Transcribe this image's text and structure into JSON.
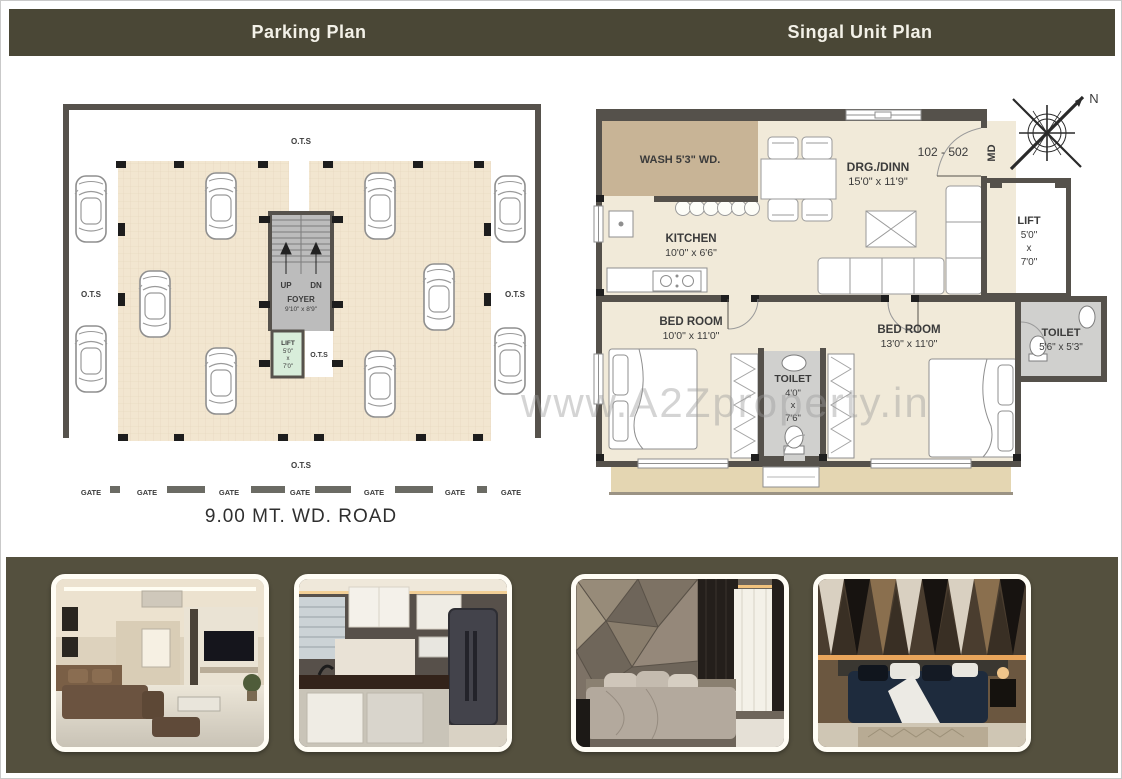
{
  "header": {
    "left_title": "Parking Plan",
    "right_title": "Singal Unit Plan"
  },
  "parking_plan": {
    "ots_top": "O.T.S",
    "ots_left": "O.T.S",
    "ots_right": "O.T.S",
    "ots_bottom": "O.T.S",
    "ots_inner": "O.T.S",
    "stair_up": "UP",
    "stair_dn": "DN",
    "foyer_name": "FOYER",
    "foyer_size": "9'10\" x 8'9\"",
    "lift_name": "LIFT",
    "lift_w": "5'0\"",
    "lift_x": "x",
    "lift_h": "7'0\"",
    "gates": [
      "GATE",
      "GATE",
      "GATE",
      "GATE",
      "GATE",
      "GATE",
      "GATE"
    ],
    "road_label": "9.00 MT. WD. ROAD"
  },
  "unit_plan": {
    "unit_range": "102 - 502",
    "main_door": "MD",
    "compass_north": "N",
    "wash_label": "WASH 5'3\" WD.",
    "kitchen_name": "KITCHEN",
    "kitchen_size": "10'0\" x 6'6\"",
    "drg_name": "DRG./DINN",
    "drg_size": "15'0\" x 11'9\"",
    "lift_name": "LIFT",
    "lift_w": "5'0\"",
    "lift_x": "x",
    "lift_h": "7'0\"",
    "toilet_attached_name": "TOILET",
    "toilet_attached_size": "5'6\" x 5'3\"",
    "bedroom_left_name": "BED ROOM",
    "bedroom_left_size": "10'0\" x 11'0\"",
    "bedroom_right_name": "BED ROOM",
    "bedroom_right_size": "13'0\" x 11'0\"",
    "toilet_center_name": "TOILET",
    "toilet_center_w": "4'0\"",
    "toilet_center_x": "x",
    "toilet_center_h": "7'6\""
  },
  "watermark": "www.A2Zproperty.in",
  "photos": [
    {
      "alt": "living-room-interior"
    },
    {
      "alt": "modular-kitchen-interior"
    },
    {
      "alt": "master-bedroom-interior"
    },
    {
      "alt": "bedroom-accent-wall-interior"
    }
  ],
  "colors": {
    "header_bg": "#4a4736",
    "strip_bg": "#54503e",
    "wall": "#55514b",
    "parking_floor": "#f2e6d0",
    "room_floor": "#f1ead9",
    "wash": "#c8b496",
    "balcony": "#e4d6b2",
    "lift": "#d8edda",
    "toilet": "#d0d0ce",
    "unit_number_red": "#b23c36"
  }
}
